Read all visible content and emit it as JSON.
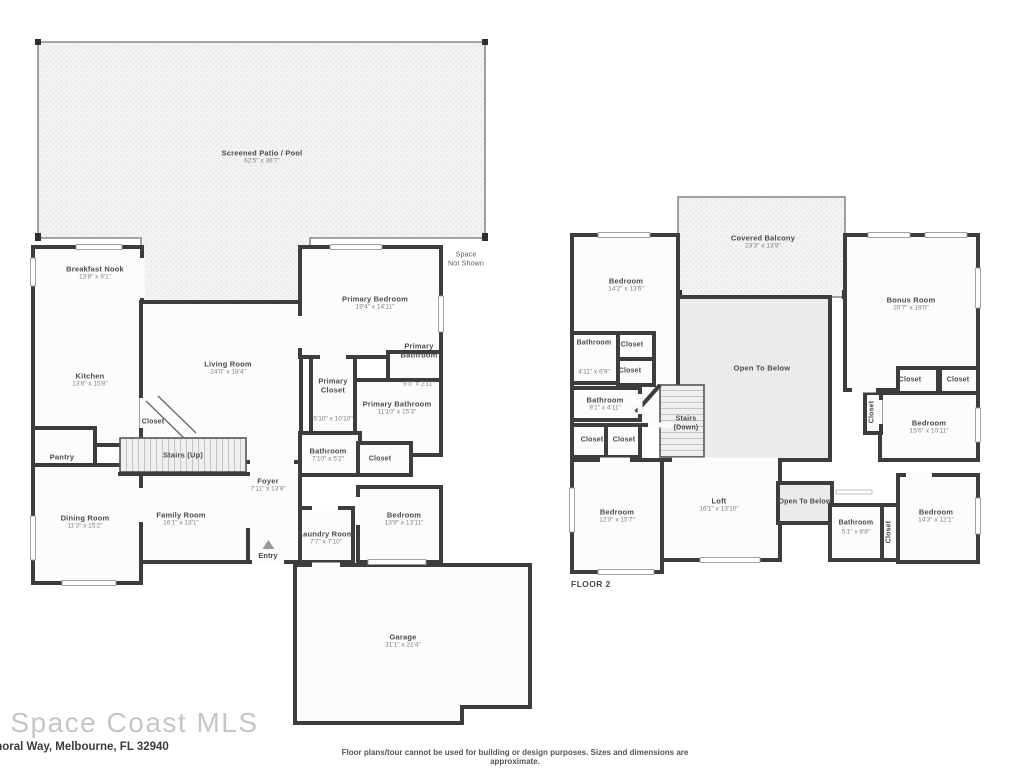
{
  "page": {
    "watermark": "e Space Coast MLS",
    "address": "moral Way, Melbourne, FL 32940",
    "disclaimer": "Floor plans/tour cannot be used for building or design purposes. Sizes and dimensions are approximate."
  },
  "floor1": {
    "patio": {
      "name": "Screened Patio / Pool",
      "dims": "62'5\" x 36'7\""
    },
    "breakfast_nook": {
      "name": "Breakfast Nook",
      "dims": "13'8\" x 9'1\""
    },
    "kitchen": {
      "name": "Kitchen",
      "dims": "13'8\" x 15'8\""
    },
    "pantry": {
      "name": "Pantry"
    },
    "dining_room": {
      "name": "Dining Room",
      "dims": "11'3\" x 15'2\""
    },
    "living_room": {
      "name": "Living Room",
      "dims": "24'0\" x 18'4\""
    },
    "closet_stairs": {
      "name": "Closet"
    },
    "stairs": {
      "name": "Stairs (Up)"
    },
    "foyer": {
      "name": "Foyer",
      "dims": "7'11\" x 13'9\""
    },
    "family_room": {
      "name": "Family Room",
      "dims": "16'1\" x 13'1\""
    },
    "entry": {
      "name": "Entry"
    },
    "primary_bedroom": {
      "name": "Primary Bedroom",
      "dims": "19'4\" x 14'11\""
    },
    "primary_bathroom_small": {
      "name": "Primary\nBathroom",
      "dims": "6'5\" x 2'11\""
    },
    "primary_closet": {
      "name": "Primary\nCloset",
      "dims": "5'10\" x 10'10\""
    },
    "primary_bathroom": {
      "name": "Primary Bathroom",
      "dims": "11'10\" x 15'3\""
    },
    "bathroom": {
      "name": "Bathroom",
      "dims": "7'10\" x 5'2\""
    },
    "closet_hall": {
      "name": "Closet"
    },
    "bedroom": {
      "name": "Bedroom",
      "dims": "13'9\" x 13'11\""
    },
    "laundry": {
      "name": "Laundry Room",
      "dims": "7'7\" x 7'10\""
    },
    "garage": {
      "name": "Garage",
      "dims": "31'1\" x 21'4\""
    },
    "space_not_shown": "Space\nNot Shown"
  },
  "floor2": {
    "label": "FLOOR 2",
    "covered_balcony": {
      "name": "Covered Balcony",
      "dims": "23'3\" x 13'9\""
    },
    "bedroom_tl": {
      "name": "Bedroom",
      "dims": "14'2\" x 13'6\""
    },
    "bonus_room": {
      "name": "Bonus Room",
      "dims": "20'7\" x 19'0\""
    },
    "open_to_below": {
      "name": "Open To Below"
    },
    "bathroom_small": {
      "name": "Bathroom",
      "dims": "4'11\" x 6'9\""
    },
    "closet_a": {
      "name": "Closet"
    },
    "closet_b": {
      "name": "Closet"
    },
    "bathroom_hall": {
      "name": "Bathroom",
      "dims": "9'1\" x 4'11\""
    },
    "stairs_down": {
      "name": "Stairs\n(Down)"
    },
    "closet_c": {
      "name": "Closet"
    },
    "closet_d": {
      "name": "Closet"
    },
    "bedroom_bl": {
      "name": "Bedroom",
      "dims": "12'0\" x 15'7\""
    },
    "loft": {
      "name": "Loft",
      "dims": "16'1\" x 13'10\""
    },
    "open_to_below_small": {
      "name": "Open To Below"
    },
    "bathroom_br": {
      "name": "Bathroom",
      "dims": "5'1\" x 8'8\""
    },
    "closet_v1": {
      "name": "Closet"
    },
    "bedroom_br": {
      "name": "Bedroom",
      "dims": "14'3\" x 12'1\""
    },
    "bedroom_mr": {
      "name": "Bedroom",
      "dims": "15'6\" x 10'11\""
    },
    "closet_e": {
      "name": "Closet"
    },
    "closet_f": {
      "name": "Closet"
    },
    "closet_v2": {
      "name": "Closet"
    }
  }
}
